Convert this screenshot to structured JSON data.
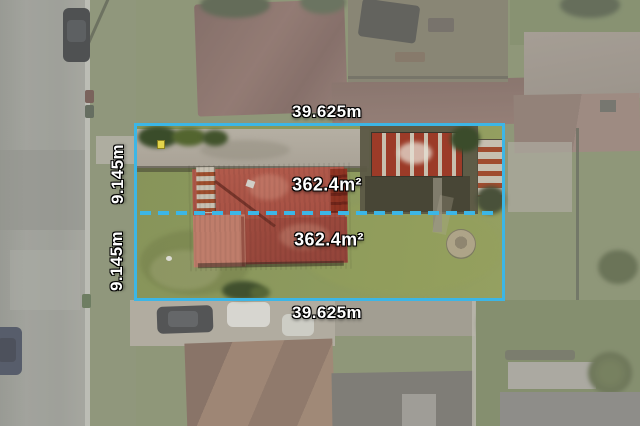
{
  "overlay": {
    "accent_color": "#3cb6e6",
    "label_text_color": "#ffffff",
    "frontage_top_label": "39.625m",
    "frontage_bottom_label": "39.625m",
    "depth_upper_label": "9.145m",
    "depth_lower_label": "9.145m",
    "area_upper_label": "362.4m²",
    "area_lower_label": "362.4m²"
  }
}
